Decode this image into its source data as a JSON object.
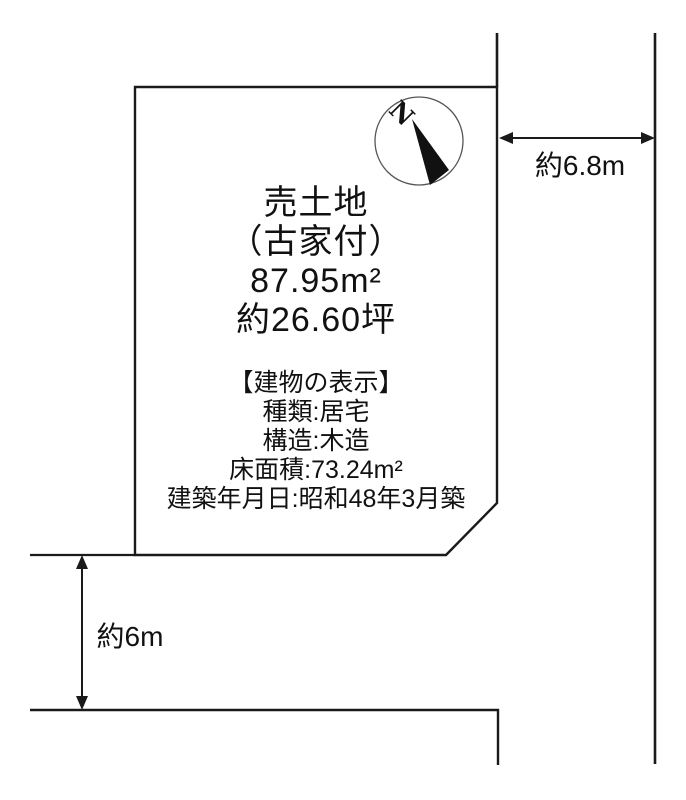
{
  "page": {
    "background_color": "#ffffff",
    "line_color": "#1a1a1a"
  },
  "parcel": {
    "title": "売土地",
    "subtitle": "（古家付）",
    "area_sqm": "87.95m²",
    "area_tsubo": "約26.60坪"
  },
  "building": {
    "header": "【建物の表示】",
    "type": "種類:居宅",
    "structure": "構造:木造",
    "floor_area": "床面積:73.24m²",
    "built_date": "建築年月日:昭和48年3月築"
  },
  "dimensions": {
    "right_road_width": "約6.8m",
    "bottom_road_width": "約6m"
  },
  "compass": {
    "north_label": "N"
  }
}
